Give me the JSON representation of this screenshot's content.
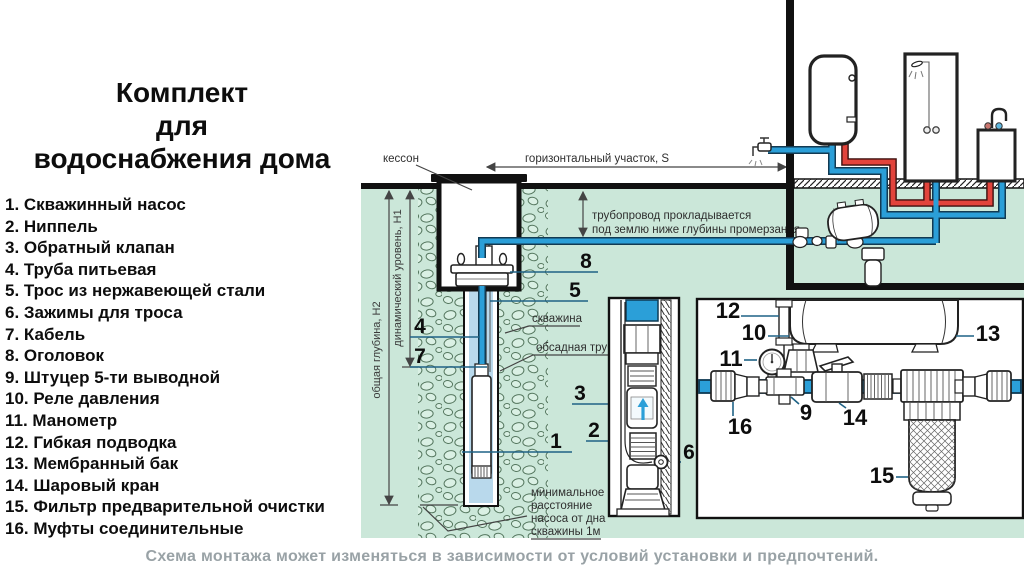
{
  "title": {
    "lines": [
      "Комплект",
      "для",
      "водоснабжения дома"
    ]
  },
  "parts_list": {
    "items": [
      "1. Скважинный насос",
      "2. Ниппель",
      "3. Обратный клапан",
      "4. Труба питьевая",
      "5. Трос из нержавеющей стали",
      "6. Зажимы для троса",
      "7. Кабель",
      "8. Оголовок",
      "9. Штуцер 5-ти выводной",
      "10. Реле давления",
      "11. Манометр",
      "12. Гибкая подводка",
      "13. Мембранный бак",
      "14. Шаровый кран",
      "15. Фильтр предварительной очистки",
      "16. Муфты соединительные"
    ]
  },
  "diagram": {
    "labels": {
      "kesson": "кессон",
      "horizontal_section": "горизонтальный участок, S",
      "pipe_note1": "трубопровод прокладывается",
      "pipe_note2": "под землю ниже глубины промерзания",
      "total_depth": "общая глубина, H2",
      "dynamic_level": "динамический уровень, H1",
      "borehole": "скважина",
      "casing": "обсадная труба",
      "min1": "минимальное",
      "min2": "расстояние",
      "min3": "насоса от дна",
      "min4": "скважины 1м"
    },
    "callouts": {
      "c1": "1",
      "c2": "2",
      "c3": "3",
      "c4": "4",
      "c5": "5",
      "c6": "6",
      "c7": "7",
      "c8": "8",
      "c9": "9",
      "c10": "10",
      "c11": "11",
      "c12": "12",
      "c13": "13",
      "c14": "14",
      "c15": "15",
      "c16": "16"
    }
  },
  "caption": "Схема монтажа может изменяться в зависимости от условий установки и предпочтений.",
  "colors": {
    "cold_pipe": "#2b9fd8",
    "hot_pipe": "#e2443c",
    "ground": "#cbe7d9",
    "well_water": "#b9d9ec",
    "caption_gray": "#99a2a6",
    "leader": "#1f6285"
  }
}
